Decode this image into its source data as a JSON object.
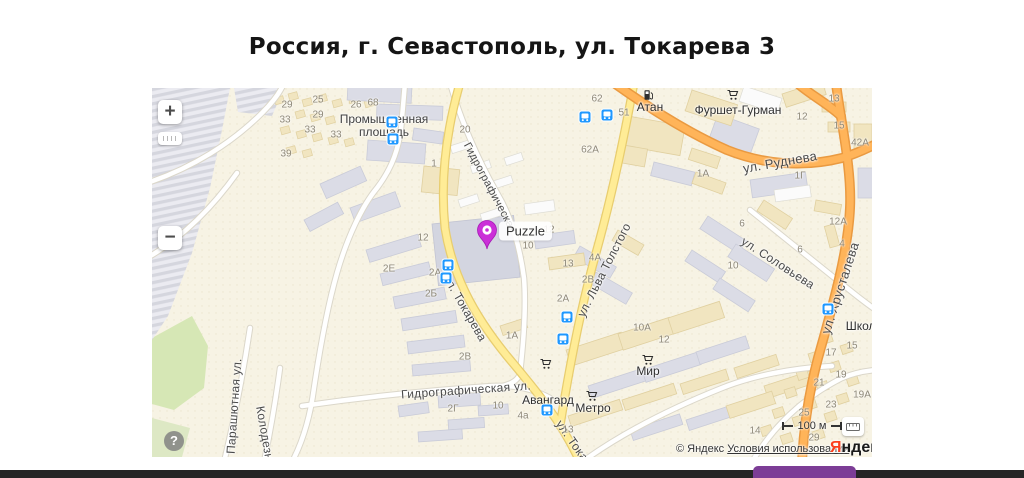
{
  "page": {
    "title": "Россия, г. Севастополь, ул. Токарева 3"
  },
  "footer": {
    "bar_color": "#262626",
    "accent_color": "#7c3d96"
  },
  "map": {
    "controls": {
      "zoom_in": "+",
      "zoom_out": "−",
      "help": "?"
    },
    "scale": {
      "label": "100 м"
    },
    "attribution": {
      "copyright": "© Яндекс",
      "terms_link": "Условия использования",
      "logo_first": "Я",
      "logo_rest": "ндекс"
    },
    "pin": {
      "label": "Puzzle",
      "color": "#cb2fd8",
      "x": 335,
      "y": 163
    },
    "colors": {
      "road_yellow": "#ffec96",
      "road_orange": "#ffb459",
      "road_white": "#ffffff",
      "building_gray": "#dbdce6",
      "building_beige": "#f1e5c0",
      "green": "#d6e7b5",
      "transit_blue": "#1f98ff",
      "background": "#f7f3e4"
    },
    "place_labels": [
      {
        "text": "Промышленная\nплощадь",
        "x": 232,
        "y": 38
      }
    ],
    "street_labels": [
      {
        "text": "ул. Руднева",
        "x": 628,
        "y": 74,
        "rot": -10,
        "size": 13
      },
      {
        "text": "ул. Хрусталева",
        "x": 688,
        "y": 200,
        "rot": -72,
        "size": 13
      },
      {
        "text": "ул. Соловьева",
        "x": 626,
        "y": 175,
        "rot": 33,
        "size": 12
      },
      {
        "text": "ул. Льва Толстого",
        "x": 452,
        "y": 182,
        "rot": -63,
        "size": 12
      },
      {
        "text": "ул. Токарева",
        "x": 313,
        "y": 220,
        "rot": 60,
        "size": 12
      },
      {
        "text": "ул. Токарева",
        "x": 428,
        "y": 364,
        "rot": 55,
        "size": 12
      },
      {
        "text": "Гидрографическая",
        "x": 338,
        "y": 100,
        "rot": 62,
        "size": 11
      },
      {
        "text": "Гидрографическая ул.",
        "x": 314,
        "y": 302,
        "rot": -4,
        "size": 12
      },
      {
        "text": "Парашютная ул.",
        "x": 82,
        "y": 318,
        "rot": -86,
        "size": 12
      },
      {
        "text": "Колодезная",
        "x": 114,
        "y": 352,
        "rot": 80,
        "size": 12
      }
    ],
    "poi_labels": [
      {
        "text": "Атан",
        "icon": "fuel-icon",
        "lx": 498,
        "ly": 19,
        "ix": 497,
        "iy": 7
      },
      {
        "text": "Фуршет-Гурман",
        "icon": "cart-icon",
        "lx": 586,
        "ly": 22,
        "ix": 581,
        "iy": 7
      },
      {
        "text": "Авангард",
        "icon": "cart-icon",
        "lx": 396,
        "ly": 312,
        "ix": 394,
        "iy": 276
      },
      {
        "text": "Метро",
        "icon": "cart-icon",
        "lx": 441,
        "ly": 320,
        "ix": 440,
        "iy": 308
      },
      {
        "text": "Мир",
        "icon": "cart-icon",
        "lx": 496,
        "ly": 283,
        "ix": 496,
        "iy": 272
      },
      {
        "text": "Школа",
        "icon": null,
        "lx": 712,
        "ly": 238,
        "ix": 0,
        "iy": 0
      }
    ],
    "transit_stops": [
      {
        "x": 240,
        "y": 34
      },
      {
        "x": 241,
        "y": 51
      },
      {
        "x": 433,
        "y": 29
      },
      {
        "x": 455,
        "y": 27
      },
      {
        "x": 296,
        "y": 177
      },
      {
        "x": 294,
        "y": 190
      },
      {
        "x": 415,
        "y": 229
      },
      {
        "x": 411,
        "y": 251
      },
      {
        "x": 395,
        "y": 322
      },
      {
        "x": 676,
        "y": 221
      }
    ],
    "house_numbers": [
      {
        "t": "29",
        "x": 135,
        "y": 17
      },
      {
        "t": "33",
        "x": 133,
        "y": 32
      },
      {
        "t": "25",
        "x": 166,
        "y": 12
      },
      {
        "t": "29",
        "x": 166,
        "y": 27
      },
      {
        "t": "33",
        "x": 158,
        "y": 42
      },
      {
        "t": "33",
        "x": 184,
        "y": 47
      },
      {
        "t": "39",
        "x": 134,
        "y": 66
      },
      {
        "t": "26",
        "x": 204,
        "y": 17
      },
      {
        "t": "68",
        "x": 221,
        "y": 15
      },
      {
        "t": "20",
        "x": 313,
        "y": 42
      },
      {
        "t": "1",
        "x": 282,
        "y": 76
      },
      {
        "t": "62",
        "x": 445,
        "y": 11
      },
      {
        "t": "51",
        "x": 472,
        "y": 25
      },
      {
        "t": "62А",
        "x": 438,
        "y": 62
      },
      {
        "t": "12",
        "x": 650,
        "y": 29
      },
      {
        "t": "13",
        "x": 682,
        "y": 11
      },
      {
        "t": "15",
        "x": 687,
        "y": 38
      },
      {
        "t": "42А",
        "x": 708,
        "y": 55
      },
      {
        "t": "1Г",
        "x": 648,
        "y": 88
      },
      {
        "t": "1А",
        "x": 551,
        "y": 86
      },
      {
        "t": "12",
        "x": 397,
        "y": 142
      },
      {
        "t": "10",
        "x": 376,
        "y": 158
      },
      {
        "t": "13",
        "x": 416,
        "y": 176
      },
      {
        "t": "4А",
        "x": 443,
        "y": 170
      },
      {
        "t": "2В",
        "x": 436,
        "y": 192
      },
      {
        "t": "2А",
        "x": 411,
        "y": 211
      },
      {
        "t": "12",
        "x": 271,
        "y": 150
      },
      {
        "t": "2Е",
        "x": 237,
        "y": 181
      },
      {
        "t": "2А",
        "x": 283,
        "y": 185
      },
      {
        "t": "2Б",
        "x": 279,
        "y": 206
      },
      {
        "t": "2В",
        "x": 313,
        "y": 269
      },
      {
        "t": "1А",
        "x": 360,
        "y": 248
      },
      {
        "t": "2Г",
        "x": 301,
        "y": 321
      },
      {
        "t": "10",
        "x": 346,
        "y": 318
      },
      {
        "t": "4а",
        "x": 371,
        "y": 328
      },
      {
        "t": "13",
        "x": 416,
        "y": 342
      },
      {
        "t": "12",
        "x": 512,
        "y": 252
      },
      {
        "t": "10А",
        "x": 490,
        "y": 240
      },
      {
        "t": "6",
        "x": 590,
        "y": 136
      },
      {
        "t": "6",
        "x": 648,
        "y": 162
      },
      {
        "t": "12А",
        "x": 686,
        "y": 134
      },
      {
        "t": "4",
        "x": 690,
        "y": 156
      },
      {
        "t": "10",
        "x": 581,
        "y": 178
      },
      {
        "t": "15",
        "x": 700,
        "y": 258
      },
      {
        "t": "17",
        "x": 679,
        "y": 265
      },
      {
        "t": "19",
        "x": 689,
        "y": 287
      },
      {
        "t": "21",
        "x": 667,
        "y": 295
      },
      {
        "t": "19А",
        "x": 710,
        "y": 307
      },
      {
        "t": "23",
        "x": 679,
        "y": 317
      },
      {
        "t": "25",
        "x": 652,
        "y": 325
      },
      {
        "t": "14",
        "x": 603,
        "y": 343
      },
      {
        "t": "29",
        "x": 662,
        "y": 350
      }
    ]
  }
}
